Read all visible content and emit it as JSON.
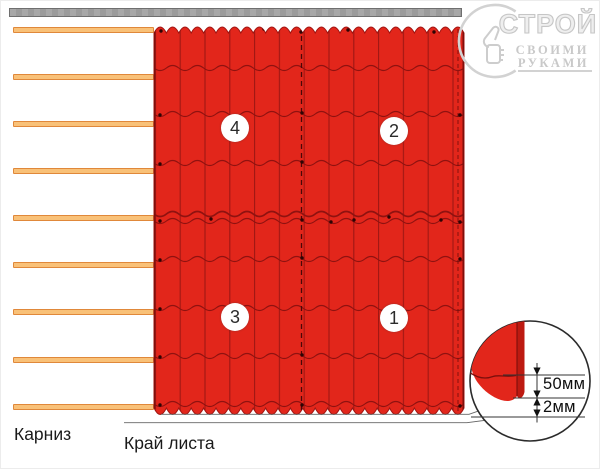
{
  "diagram": {
    "bottom_labels": {
      "cornice": "Карниз",
      "sheet_edge": "Край листа"
    },
    "sheet_order": [
      {
        "label": "1"
      },
      {
        "label": "2"
      },
      {
        "label": "3"
      },
      {
        "label": "4"
      }
    ],
    "detail_view": {
      "dim_overhang": "50мм",
      "dim_gap": "2мм"
    },
    "watermark": {
      "name": "СТРОЙ",
      "tagline_1": "СВОИМИ",
      "tagline_2": "РУКАМИ"
    },
    "colors": {
      "tile_red": "#e2261b",
      "tile_line_dark": "#8f1210",
      "batten_fill": "#f9c178",
      "batten_border": "#e0883a",
      "board_gray": "#a3a3a3",
      "watermark_gray": "#cacaca"
    }
  }
}
